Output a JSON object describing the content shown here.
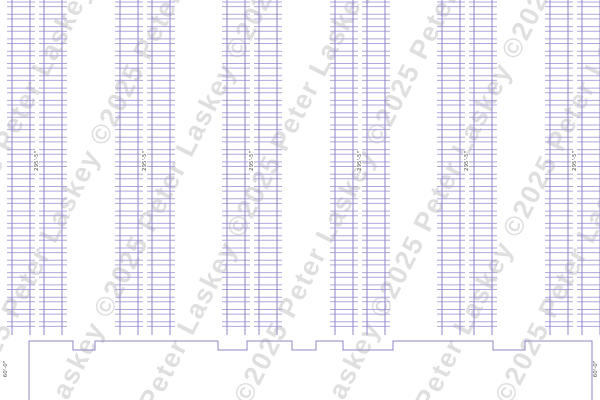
{
  "watermark": {
    "angle_deg": -63,
    "color": "#8f8f8f",
    "opacity": 0.28,
    "font_size": 27,
    "stripes": [
      {
        "x": -15,
        "y": 200,
        "text": "Peter Laskey ©2025 Peter Laskey"
      },
      {
        "x": 78,
        "y": 200,
        "text": "©2025 Peter Laskey ©2025 Peter"
      },
      {
        "x": 170,
        "y": 200,
        "text": "Laskey ©2025 Peter Laskey ©2025"
      },
      {
        "x": 262,
        "y": 200,
        "text": "Peter Laskey ©2025 Peter Laskey"
      },
      {
        "x": 354,
        "y": 200,
        "text": "©2025 Peter Laskey ©2025 Peter"
      },
      {
        "x": 446,
        "y": 200,
        "text": "Laskey ©2025 Peter Laskey ©2025"
      },
      {
        "x": 538,
        "y": 200,
        "text": "Peter Laskey ©2025 Peter Laskey"
      },
      {
        "x": 615,
        "y": 200,
        "text": "©2025 Peter Laskey ©2025 Peter"
      }
    ]
  },
  "drawing": {
    "canvas": {
      "width": 600,
      "height": 400,
      "background": "#ffffff"
    },
    "colors": {
      "rail": "#8e85c6",
      "rung": "#b1a7dd",
      "outline": "#9087c7",
      "dim_text": "#4d4d4d"
    },
    "rack_rows": [
      {
        "name": "rack-row-1",
        "center_x": 37,
        "length_label": "295'-5\""
      },
      {
        "name": "rack-row-2",
        "center_x": 145,
        "length_label": "295'-5\""
      },
      {
        "name": "rack-row-3",
        "center_x": 252,
        "length_label": "295'-5\""
      },
      {
        "name": "rack-row-4",
        "center_x": 360,
        "length_label": "295'-5\""
      },
      {
        "name": "rack-row-5",
        "center_x": 467,
        "length_label": "295'-5\""
      },
      {
        "name": "rack-row-6",
        "center_x": 575,
        "length_label": "295'-5\""
      }
    ],
    "rack_geometry": {
      "top_y": 0,
      "bottom_y": 335,
      "first_beam_y": 2,
      "bay_pitch": 12.3,
      "beam_gap": 4.6,
      "rail_offsets": [
        -25,
        -7,
        7,
        25
      ],
      "half_width": 30,
      "flue_half_gap": 2,
      "label_y": 161,
      "label_font_size": 5.5
    },
    "building": {
      "floor_line_y": 341,
      "notch_bottom_y": 350,
      "left_wall_x": 29,
      "right_wall_x": 592,
      "bottom_edge_y": 400,
      "dock_notches": [
        [
          73,
          95
        ],
        [
          218,
          247
        ],
        [
          292,
          316
        ],
        [
          343,
          393
        ],
        [
          493,
          525
        ]
      ],
      "left_dimension": {
        "label": "60'-0\"",
        "x": 7,
        "y": 369
      },
      "right_dimension": {
        "label": "60'-0\"",
        "x": 597,
        "y": 369
      },
      "dim_font_size": 5.5
    }
  }
}
